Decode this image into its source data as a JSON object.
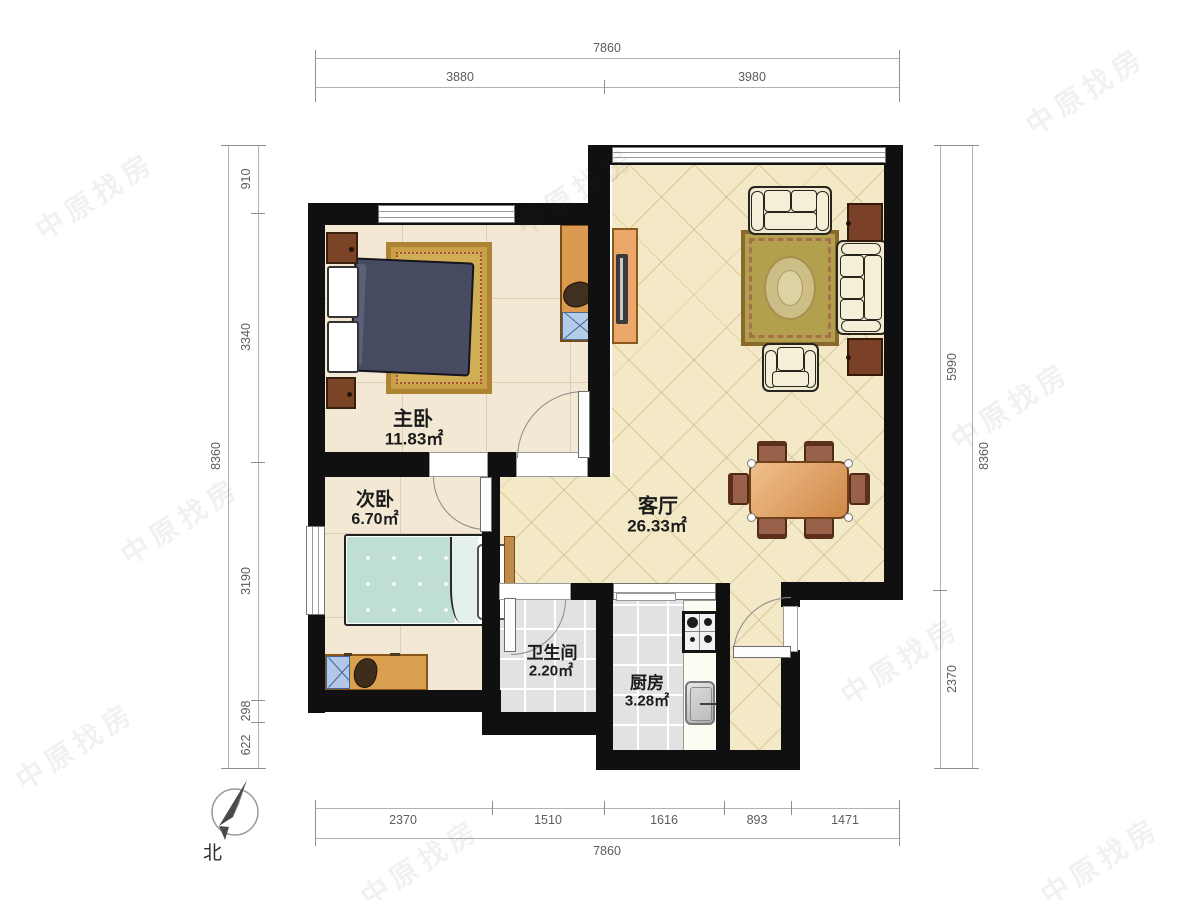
{
  "rooms": [
    {
      "name": "主卧",
      "area": "11.83㎡"
    },
    {
      "name": "次卧",
      "area": "6.70㎡"
    },
    {
      "name": "客厅",
      "area": "26.33㎡"
    },
    {
      "name": "卫生间",
      "area": "2.20㎡"
    },
    {
      "name": "厨房",
      "area": "3.28㎡"
    }
  ],
  "dims": {
    "top": {
      "total": "7860",
      "segments": [
        "3880",
        "3980"
      ]
    },
    "bottom": {
      "total": "7860",
      "segments": [
        "2370",
        "1510",
        "1616",
        "893",
        "1471"
      ]
    },
    "left": {
      "total": "8360",
      "segments": [
        "910",
        "3340",
        "3190",
        "298",
        "622"
      ]
    },
    "right": {
      "total": "8360",
      "segments": [
        "5990",
        "2370"
      ]
    }
  },
  "compass": {
    "north_label": "北"
  },
  "watermark": {
    "text": "中原找房"
  },
  "colors": {
    "wall": "#101010",
    "living_floor": "#f3e9c6",
    "bedroom_floor": "#f2e8d4",
    "tile_floor": "#e2e2e2",
    "rug_gold": "#c9a045",
    "bed_navy": "#464b61",
    "bed_teal": "#bfded5",
    "wood": "#d9a050",
    "sofa_cream": "#f0ead0",
    "side_table_brown": "#7a4028"
  }
}
